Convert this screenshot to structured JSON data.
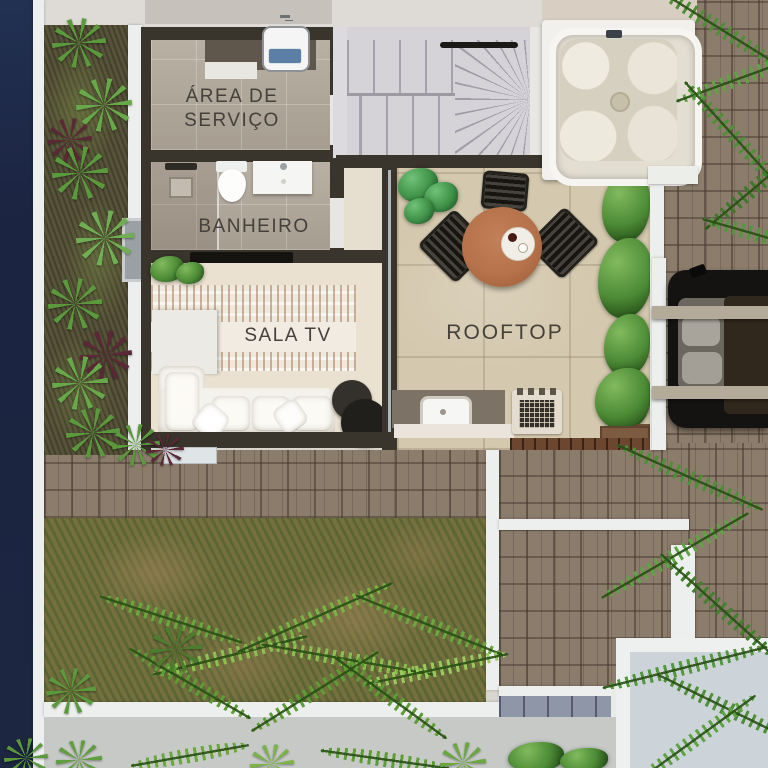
{
  "plan_type": "rooftop-floor-plan-render",
  "rooms": {
    "area_servico": {
      "line1": "ÁREA DE",
      "line2": "SERVIÇO"
    },
    "banheiro": {
      "label": "BANHEIRO"
    },
    "sala_tv": {
      "label": "SALA TV"
    },
    "rooftop": {
      "label": "ROOFTOP"
    }
  },
  "objects": [
    "laundry-sink",
    "counter",
    "shower",
    "floor-drain",
    "toilet",
    "vanity-sink",
    "tv",
    "sideboard",
    "sofa",
    "throw-pillows",
    "side-tables",
    "area-rug",
    "houseplant",
    "stairs",
    "handrail",
    "hot-tub",
    "dining-table",
    "serving-tray",
    "dining-chairs",
    "privacy-hedge",
    "planter-box",
    "outdoor-sink",
    "bbq-grill",
    "wood-deck",
    "car",
    "pergola-beams",
    "carport-post",
    "lawn",
    "palm-plants",
    "shrubs",
    "brick-paving",
    "doormat",
    "window",
    "garden-bed",
    "neighbor-terrace"
  ],
  "colors": {
    "site_border_navy": "#1c2641",
    "wall_white": "#edefee",
    "wall_dark": "#39342c",
    "floor_tile_gray": "#b1a79a",
    "floor_sala_cream": "#eae1d1",
    "floor_rooftop_beige": "#d4c8ae",
    "stair_gray": "#d5d3d8",
    "paving_brown": "#8b7c6c",
    "paving_blue": "#8f96a8",
    "grass_olive": "#75713f",
    "foliage_green": "#569338",
    "table_wood": "#b5724b",
    "label_text": "#45403a"
  }
}
